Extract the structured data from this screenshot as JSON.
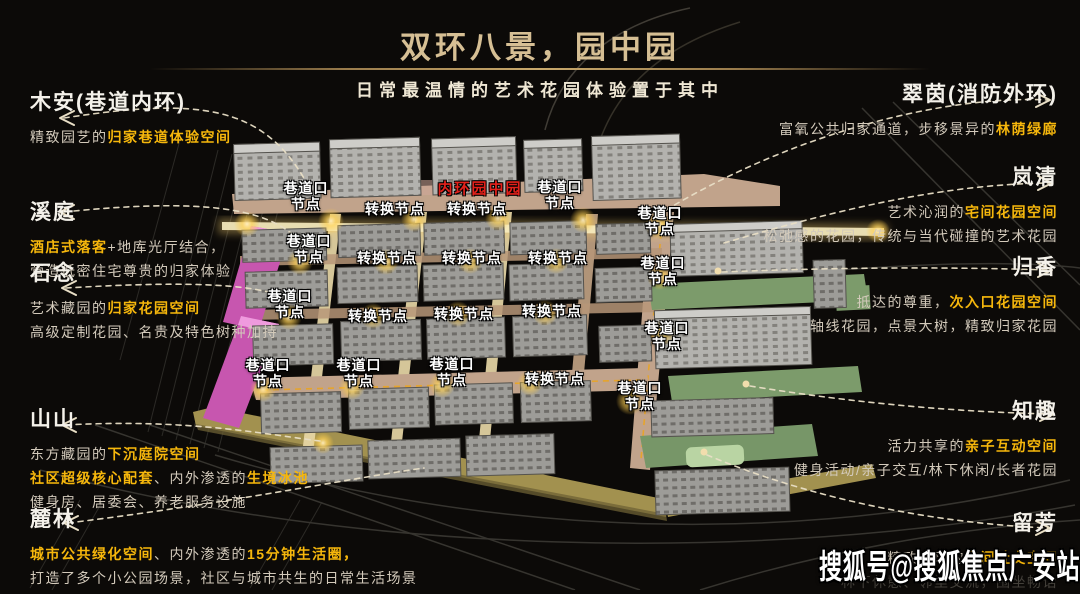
{
  "header": {
    "title": "双环八景，园中园",
    "subtitle": "日常最温情的艺术花园体验置于其中"
  },
  "colors": {
    "gold_title": "#d6bf94",
    "highlight_yellow": "#f6b70c",
    "inner_ring_red": "#e3211b",
    "pink_building": "#c756af",
    "lawn_green": "#7c9b6b",
    "road_tan": "#c1a38b",
    "node_glow": "#ffd257"
  },
  "left_annotations": [
    {
      "title": "木安(巷道内环)",
      "lines": [
        [
          {
            "t": "精致园艺的"
          },
          {
            "t": "归家巷道体验空间",
            "h": 1
          }
        ]
      ]
    },
    {
      "title": "溪庭",
      "lines": [
        [
          {
            "t": "酒店式落客",
            "h": 1
          },
          {
            "t": "+地库光厅结合，"
          }
        ],
        [
          {
            "t": "营造低密住宅尊贵的归家体验"
          }
        ]
      ]
    },
    {
      "title": "石念",
      "lines": [
        [
          {
            "t": "艺术藏园的"
          },
          {
            "t": "归家花园空间",
            "h": 1
          }
        ],
        [
          {
            "t": "高级定制花园、名贵及特色树种加持"
          }
        ]
      ]
    },
    {
      "title": "山山",
      "lines": [
        [
          {
            "t": "东方藏园的"
          },
          {
            "t": "下沉庭院空间",
            "h": 1
          }
        ],
        [
          {
            "t": "社区超级核心配套",
            "h": 1
          },
          {
            "t": "、内外渗透的"
          },
          {
            "t": "生境冰池",
            "h": 1
          }
        ],
        [
          {
            "t": "健身房、居委会、养老服务设施"
          }
        ]
      ]
    },
    {
      "title": "麓林",
      "lines": [
        [
          {
            "t": "城市公共绿化空间",
            "h": 1
          },
          {
            "t": "、内外渗透的"
          },
          {
            "t": "15分钟生活圈，",
            "h": 1
          }
        ],
        [
          {
            "t": "打造了多个小公园场景，社区与城市共生的日常生活场景"
          }
        ]
      ]
    }
  ],
  "right_annotations": [
    {
      "title": "翠茵(消防外环)",
      "lines": [
        [
          {
            "t": "富氧公共归家通道，步移景异的"
          },
          {
            "t": "林荫绿廊",
            "h": 1
          }
        ]
      ]
    },
    {
      "title": "岚清",
      "lines": [
        [
          {
            "t": "艺术沁润的"
          },
          {
            "t": "宅间花园空间",
            "h": 1
          }
        ],
        [
          {
            "t": "松弛感的花园，传统与当代碰撞的艺术花园"
          }
        ]
      ]
    },
    {
      "title": "归香",
      "lines": [
        [
          {
            "t": "抵达的尊重，"
          },
          {
            "t": "次入口花园空间",
            "h": 1
          }
        ],
        [
          {
            "t": "轴线花园，点景大树，精致归家花园"
          }
        ]
      ]
    },
    {
      "title": "知趣",
      "lines": [
        [
          {
            "t": "活力共享的"
          },
          {
            "t": "亲子互动空间",
            "h": 1
          }
        ],
        [
          {
            "t": "健身活动/亲子交互/林下休闲/长者花园"
          }
        ]
      ]
    },
    {
      "title": "留芳",
      "lines": [
        [
          {
            "t": "精致私享的"
          },
          {
            "t": "宅间社交空间",
            "h": 1
          }
        ],
        [
          {
            "t": "林下休憩、邻里交流，围坐畅话",
            "dim": 1
          }
        ]
      ]
    }
  ],
  "map": {
    "center_label": "内环园中园",
    "labels": {
      "junction": "巷道口\n节点",
      "transfer": "转换节点"
    },
    "nodes": [
      {
        "type": "junction",
        "x": 306,
        "y": 196
      },
      {
        "type": "transfer",
        "x": 395,
        "y": 209
      },
      {
        "type": "transfer",
        "x": 477,
        "y": 209
      },
      {
        "type": "junction",
        "x": 560,
        "y": 195
      },
      {
        "type": "junction",
        "x": 660,
        "y": 221
      },
      {
        "type": "junction",
        "x": 309,
        "y": 249
      },
      {
        "type": "transfer",
        "x": 387,
        "y": 258
      },
      {
        "type": "transfer",
        "x": 472,
        "y": 258
      },
      {
        "type": "transfer",
        "x": 558,
        "y": 258
      },
      {
        "type": "junction",
        "x": 663,
        "y": 271
      },
      {
        "type": "junction",
        "x": 290,
        "y": 304
      },
      {
        "type": "transfer",
        "x": 378,
        "y": 316
      },
      {
        "type": "transfer",
        "x": 464,
        "y": 314
      },
      {
        "type": "transfer",
        "x": 552,
        "y": 311
      },
      {
        "type": "junction",
        "x": 667,
        "y": 336
      },
      {
        "type": "junction",
        "x": 268,
        "y": 373
      },
      {
        "type": "junction",
        "x": 359,
        "y": 373
      },
      {
        "type": "junction",
        "x": 452,
        "y": 372
      },
      {
        "type": "transfer",
        "x": 555,
        "y": 379
      },
      {
        "type": "junction",
        "x": 640,
        "y": 396
      }
    ]
  },
  "watermark": "搜狐号@搜狐焦点广安站"
}
